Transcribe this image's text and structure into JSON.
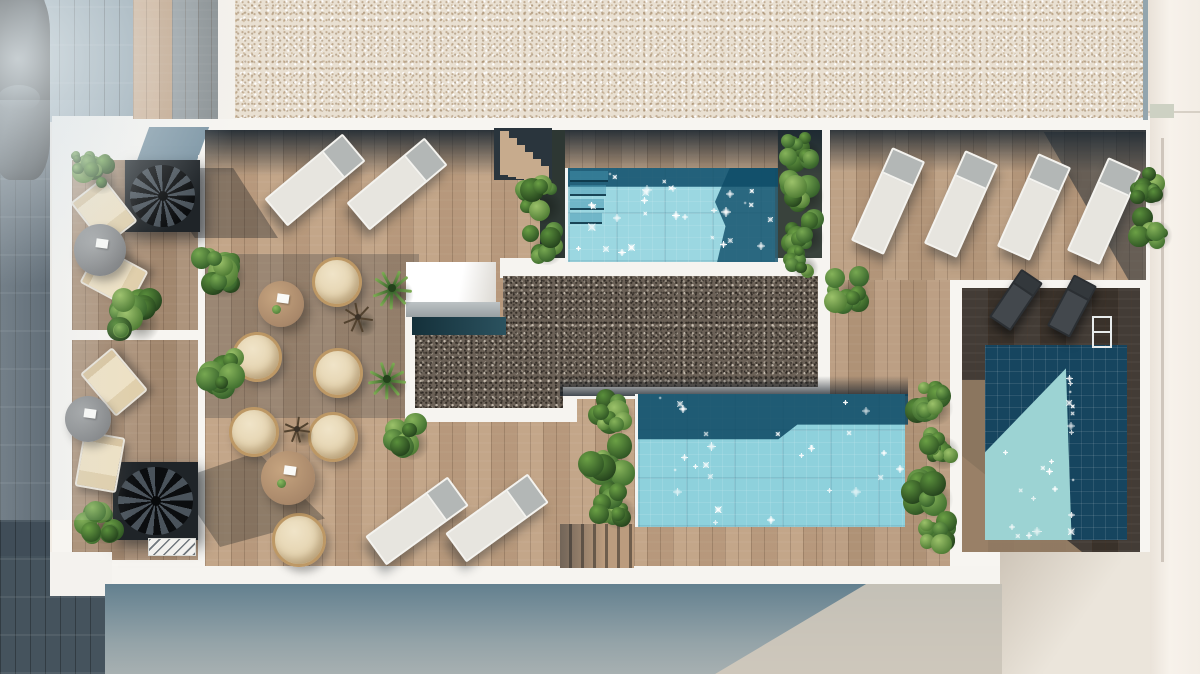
{
  "scene": {
    "label": "rooftop-terrace-aerial-render",
    "description_colors": {
      "deck_wood": "#c0a183",
      "deck_shadowed": "#8d7a68",
      "private_deck_dark": "#39322b",
      "gravel_roof_light": "#e9e0d2",
      "gravel_roof_dark": "#6b6157",
      "pool_water_light": "#9bd7e1",
      "pool_water_deep": "#16455f",
      "wall_white": "#f7f5f1",
      "street_paving": "#404d58",
      "plant_green": "#47763a",
      "lounger_pad": "#e7e5df",
      "lounger_head": "#b3b7b6",
      "cushion_beige": "#eee1c4",
      "sky_shadow_band": "#1b2731",
      "outside_wall": "#f3ede5"
    },
    "rects": [
      {
        "n": "building-wall-right",
        "x": 1145,
        "y": 0,
        "w": 55,
        "h": 674,
        "bg": "linear-gradient(90deg,#e7dfd5,#f7f2eb 45%,#f3ede5)"
      },
      {
        "n": "building-wall-edge-line",
        "x": 1161,
        "y": 138,
        "w": 3,
        "h": 424,
        "bg": "rgba(172,160,147,.5)"
      },
      {
        "n": "building-wall-hline",
        "x": 1148,
        "y": 111,
        "w": 52,
        "h": 2,
        "bg": "rgba(180,170,158,.45)"
      },
      {
        "n": "building-wall-vent",
        "x": 1150,
        "y": 104,
        "w": 24,
        "h": 14,
        "bg": "#cdd1c3"
      },
      {
        "n": "street-pavement",
        "x": 0,
        "y": 0,
        "w": 50,
        "h": 674,
        "cls": "tiles",
        "bg": "#404d58"
      },
      {
        "n": "street-pavement-lower",
        "x": 0,
        "y": 556,
        "w": 112,
        "h": 118,
        "cls": "tiles",
        "bg": "#45535d"
      },
      {
        "n": "street-pavement-upper",
        "x": 44,
        "y": 0,
        "w": 90,
        "h": 122,
        "cls": "tiles",
        "bg": "#91a4af"
      },
      {
        "n": "terrace-white-base",
        "x": 52,
        "y": 116,
        "w": 1098,
        "h": 470,
        "bg": "#f7f5f1"
      },
      {
        "n": "walkway-wood",
        "x": 133,
        "y": 0,
        "w": 39,
        "h": 119,
        "cls": "wood",
        "bg": "#cbac8e"
      },
      {
        "n": "walkway-wood-shaded",
        "x": 172,
        "y": 0,
        "w": 46,
        "h": 119,
        "cls": "wood",
        "bg": "#8e979b"
      },
      {
        "n": "walkway-wall",
        "x": 218,
        "y": 0,
        "w": 18,
        "h": 119,
        "bg": "#f4f1ec"
      },
      {
        "n": "gravel-roof-top",
        "x": 235,
        "y": 0,
        "w": 911,
        "h": 118,
        "cls": "speckle-light"
      },
      {
        "n": "gravel-top-right-edge",
        "x": 1143,
        "y": 0,
        "w": 5,
        "h": 120,
        "bg": "#93a5ae"
      },
      {
        "n": "stair-landing",
        "x": 143,
        "y": 127,
        "w": 60,
        "h": 34,
        "bg": "#7d96a5",
        "skew": -20
      },
      {
        "n": "room-1-floor",
        "x": 72,
        "y": 160,
        "w": 128,
        "h": 172,
        "cls": "wood",
        "bg": "#a98e75"
      },
      {
        "n": "room-2-floor",
        "x": 72,
        "y": 340,
        "w": 128,
        "h": 220,
        "cls": "wood",
        "bg": "#a98e75"
      },
      {
        "n": "room-divider-wall",
        "x": 60,
        "y": 330,
        "w": 145,
        "h": 10,
        "bg": "#f7f5f1"
      },
      {
        "n": "rooms-deck-wall",
        "x": 198,
        "y": 155,
        "w": 10,
        "h": 415,
        "bg": "#f7f5f1"
      },
      {
        "n": "deck-main",
        "x": 205,
        "y": 130,
        "w": 617,
        "h": 440,
        "cls": "wood",
        "bg": "#c0a183"
      },
      {
        "n": "deck-east",
        "x": 822,
        "y": 278,
        "w": 128,
        "h": 292,
        "cls": "wood",
        "bg": "#b89a7d"
      },
      {
        "n": "deck-northeast",
        "x": 830,
        "y": 130,
        "w": 316,
        "h": 150,
        "cls": "wood",
        "bg": "#bb9d80"
      },
      {
        "n": "ne-planter-bed",
        "x": 778,
        "y": 130,
        "w": 44,
        "h": 138,
        "bg": "#39423c"
      },
      {
        "n": "ne-wall",
        "x": 822,
        "y": 130,
        "w": 8,
        "h": 148,
        "bg": "#f6f4f0"
      },
      {
        "n": "shadow-deck-main-top",
        "x": 205,
        "y": 130,
        "w": 617,
        "h": 46,
        "bg": "linear-gradient(180deg,rgba(27,39,49,.9),rgba(27,39,49,0))"
      },
      {
        "n": "shadow-deck-ne-top",
        "x": 830,
        "y": 130,
        "w": 316,
        "h": 42,
        "bg": "linear-gradient(180deg,rgba(27,39,49,.85),rgba(27,39,49,0))"
      },
      {
        "n": "shadow-deck-ne-right",
        "x": 1000,
        "y": 132,
        "w": 146,
        "h": 148,
        "bg": "rgba(27,39,49,.5)",
        "clip": "polygon(30% 0,100% 0,100% 100%,88% 100%)"
      },
      {
        "n": "shadow-deck-mid-left",
        "x": 205,
        "y": 254,
        "w": 214,
        "h": 164,
        "bg": "rgba(55,58,60,.28)"
      },
      {
        "n": "planter-strip-pool-top-left",
        "x": 540,
        "y": 130,
        "w": 25,
        "h": 140,
        "bg": "#2d3733"
      },
      {
        "n": "walkway-below-pool-top",
        "x": 500,
        "y": 258,
        "w": 330,
        "h": 20,
        "bg": "#f6f4f0"
      },
      {
        "n": "gravel-left-border-wall",
        "x": 405,
        "y": 300,
        "w": 12,
        "h": 120,
        "bg": "#f6f4f0"
      },
      {
        "n": "gravel-bottom-left-border-wall",
        "x": 405,
        "y": 406,
        "w": 170,
        "h": 16,
        "bg": "#f6f4f0"
      },
      {
        "n": "gravel-bottom-right-border-wall",
        "x": 563,
        "y": 385,
        "w": 267,
        "h": 14,
        "bg": "#f6f4f0"
      },
      {
        "n": "gravel-step-corner-wall",
        "x": 563,
        "y": 385,
        "w": 14,
        "h": 37,
        "bg": "#f6f4f0"
      },
      {
        "n": "gravel-right-border-wall",
        "x": 818,
        "y": 276,
        "w": 12,
        "h": 122,
        "bg": "#f6f4f0"
      },
      {
        "n": "rooftop-skylight-box",
        "x": 406,
        "y": 262,
        "w": 90,
        "h": 40,
        "bg": "linear-gradient(100deg,#ffffff 60%,#dcd9d3)"
      },
      {
        "n": "ac-unit-ledge",
        "x": 406,
        "y": 302,
        "w": 94,
        "h": 15,
        "bg": "linear-gradient(180deg,#bcc2c4,#99a0a3)"
      },
      {
        "n": "gravel-roof-center",
        "x": 415,
        "y": 276,
        "w": 403,
        "h": 132,
        "cls": "speckle-dark",
        "clip": "polygon(88px 0px,403px 0px,403px 111px,148px 111px,148px 132px,0px 132px,0px 41px,88px 41px)"
      },
      {
        "n": "ledge-shadow-teal",
        "x": 412,
        "y": 317,
        "w": 94,
        "h": 18,
        "bg": "linear-gradient(90deg,#14303a,#2b525f)"
      },
      {
        "n": "shadow-above-pool-bottom",
        "x": 560,
        "y": 376,
        "w": 348,
        "h": 20,
        "bg": "linear-gradient(180deg,rgba(22,32,42,0),rgba(22,32,42,.8))"
      },
      {
        "n": "right-suite-floor",
        "x": 962,
        "y": 288,
        "w": 178,
        "h": 264,
        "cls": "wood",
        "bg": "#39322b"
      },
      {
        "n": "right-suite-floor-light-strip",
        "x": 962,
        "y": 380,
        "w": 26,
        "h": 172,
        "bg": "#8b765f"
      },
      {
        "n": "right-suite-floor-sun-wedge",
        "x": 962,
        "y": 432,
        "w": 120,
        "h": 120,
        "bg": "#9a8268",
        "op": ".9",
        "clip": "polygon(0 20%,100% 100%,0 100%)"
      },
      {
        "n": "terrace-south-wall",
        "x": 105,
        "y": 566,
        "w": 900,
        "h": 18,
        "bg": "#f6f4f0"
      },
      {
        "n": "south-west-wall",
        "x": 50,
        "y": 552,
        "w": 62,
        "h": 44,
        "bg": "#f4f2ee"
      },
      {
        "n": "lower-roof-floor-right",
        "x": 1000,
        "y": 552,
        "w": 150,
        "h": 122,
        "bg": "linear-gradient(125deg,#cec5b8,#ebe5db 55%)"
      },
      {
        "n": "street-below",
        "x": 105,
        "y": 584,
        "w": 897,
        "h": 90,
        "bg": "linear-gradient(180deg,#63808f,#94a3a8 65%,#a7b0b1)"
      },
      {
        "n": "street-below-sunlit",
        "x": 700,
        "y": 584,
        "w": 302,
        "h": 90,
        "bg": "#d5cbbd",
        "op": ".85",
        "clip": "polygon(55% 0,100% 0,100% 100%,5% 100%)"
      }
    ],
    "pools": [
      {
        "n": "pool-top",
        "x": 565,
        "y": 168,
        "w": 210,
        "h": 94,
        "base": "#9bd7e1",
        "borderLeft": true,
        "overlays": [
          {
            "bg": "rgba(14,76,104,.85)",
            "clip": "polygon(0 0,100% 0,100% 20%,0 20%)"
          },
          {
            "bg": "rgba(14,76,104,.8)",
            "clip": "polygon(77% 0,100% 0,100% 100%,71% 100%,75% 62%,70% 36%)"
          }
        ],
        "steps": {
          "count": 4,
          "x": 2,
          "y": 3,
          "w": 38,
          "h": 11,
          "gap": 3
        },
        "sparkles": 30,
        "seed": 7
      },
      {
        "n": "pool-bottom",
        "x": 635,
        "y": 394,
        "w": 270,
        "h": 133,
        "base": "#8ed1dc",
        "borderLeft": true,
        "overlays": [
          {
            "bg": "rgba(12,70,98,.85)",
            "clip": "polygon(0 0,100% 0,100% 23%,59% 23%,52% 34%,0 34%)"
          }
        ],
        "sparkles": 26,
        "seed": 11
      },
      {
        "n": "pool-right",
        "x": 985,
        "y": 345,
        "w": 142,
        "h": 195,
        "base": "#16455f",
        "overlays": [
          {
            "bg": "#9cd3d3",
            "clip": "polygon(57% 12%,0 55%,0 100%,61% 100%)"
          }
        ],
        "sparkles": 22,
        "seed": 5,
        "diagonal": true
      }
    ],
    "sun_loungers": [
      [
        315,
        180,
        50
      ],
      [
        397,
        184,
        50
      ],
      [
        417,
        521,
        54
      ],
      [
        497,
        518,
        54
      ],
      [
        888,
        201,
        24
      ],
      [
        961,
        204,
        24
      ],
      [
        1034,
        207,
        24
      ],
      [
        1104,
        211,
        24
      ]
    ],
    "dark_loungers": [
      [
        1016,
        300,
        34
      ],
      [
        1072,
        306,
        28
      ]
    ],
    "deck_chairs": [
      [
        104,
        212,
        -38
      ],
      [
        114,
        277,
        -62
      ],
      [
        114,
        382,
        -40
      ],
      [
        100,
        462,
        10
      ]
    ],
    "rattan_chairs": [
      [
        337,
        282,
        50
      ],
      [
        257,
        357,
        50
      ],
      [
        338,
        373,
        50
      ],
      [
        254,
        432,
        50
      ],
      [
        333,
        437,
        50
      ],
      [
        299,
        540,
        54
      ]
    ],
    "tables": [
      {
        "x": 281,
        "y": 304,
        "d": 46,
        "v": "wood"
      },
      {
        "x": 288,
        "y": 478,
        "d": 54,
        "v": "wood"
      },
      {
        "x": 100,
        "y": 250,
        "d": 52,
        "v": "gray"
      },
      {
        "x": 88,
        "y": 419,
        "d": 46,
        "v": "gray"
      }
    ],
    "plants": [
      [
        95,
        171,
        40
      ],
      [
        84,
        162,
        26
      ],
      [
        134,
        316,
        46
      ],
      [
        99,
        521,
        40
      ],
      [
        217,
        269,
        52
      ],
      [
        218,
        371,
        46
      ],
      [
        392,
        288,
        36,
        "palm"
      ],
      [
        387,
        379,
        34,
        "palm"
      ],
      [
        358,
        317,
        30,
        "twig"
      ],
      [
        297,
        429,
        26,
        "twig"
      ],
      [
        406,
        437,
        40
      ],
      [
        538,
        200,
        42
      ],
      [
        541,
        243,
        38
      ],
      [
        612,
        411,
        40
      ],
      [
        606,
        459,
        46
      ],
      [
        613,
        506,
        40
      ],
      [
        929,
        401,
        42
      ],
      [
        937,
        446,
        40
      ],
      [
        927,
        492,
        46
      ],
      [
        934,
        532,
        38
      ],
      [
        800,
        149,
        36
      ],
      [
        801,
        189,
        40
      ],
      [
        802,
        231,
        38
      ],
      [
        800,
        261,
        30
      ],
      [
        846,
        289,
        42
      ],
      [
        1148,
        186,
        34
      ],
      [
        1151,
        229,
        36
      ],
      [
        6,
        126,
        22
      ]
    ],
    "stairs": {
      "spiral": [
        {
          "x": 125,
          "y": 160,
          "w": 75,
          "h": 72
        },
        {
          "x": 113,
          "y": 462,
          "w": 85,
          "h": 78
        }
      ],
      "spiral_shadows": [
        {
          "x": 150,
          "y": 168,
          "w": 128,
          "h": 70,
          "bg": "rgba(20,26,31,.35)",
          "clip": "polygon(0 0,65% 0,100% 100%,35% 100%)"
        },
        {
          "x": 175,
          "y": 452,
          "w": 150,
          "h": 95,
          "bg": "rgba(20,26,31,.3)",
          "clip": "polygon(0 30%,55% 0,100% 70%,30% 100%)"
        }
      ],
      "steps_diag": {
        "x": 494,
        "y": 128,
        "w": 58,
        "h": 52,
        "treads": 6
      },
      "steps_bar": {
        "x": 560,
        "y": 524,
        "w": 74,
        "h": 44
      },
      "hatch_ramp": {
        "x": 148,
        "y": 538,
        "w": 48,
        "h": 18
      }
    },
    "misc": {
      "car": {
        "x": -8,
        "y": -10,
        "w": 58,
        "h": 190
      },
      "pool_ladder": {
        "x": 1092,
        "y": 316,
        "w": 20,
        "h": 32
      },
      "hazes": [
        {
          "n": "corner-haze",
          "x": -40,
          "y": -40,
          "w": 320,
          "h": 330,
          "bg": "radial-gradient(circle at 18% 30%,rgba(228,235,238,.85),rgba(228,235,238,0) 65%)"
        },
        {
          "n": "street-sun-streak",
          "x": 0,
          "y": 100,
          "w": 140,
          "h": 420,
          "bg": "linear-gradient(90deg,rgba(212,222,228,.35),rgba(212,222,228,0))"
        }
      ]
    }
  }
}
